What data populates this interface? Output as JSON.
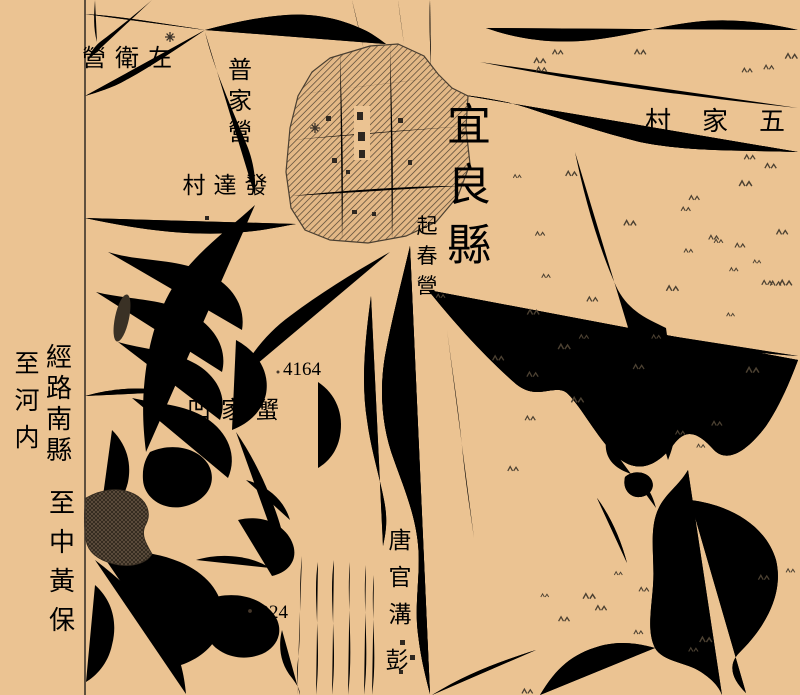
{
  "map": {
    "sheet_name": "宜良縣城附近地形圖",
    "colors": {
      "paper": "#ebc392",
      "ink": "#4c4132",
      "label": "#3a3127",
      "heavy_black": "#2e2720"
    },
    "margin_notes": [
      {
        "name": "note-to-hanoi",
        "text": "至河内",
        "mode": "v",
        "x": 27,
        "y": 372,
        "size": 25,
        "step": 37
      },
      {
        "name": "note-via-lunan-county",
        "text": "經路南縣",
        "mode": "v",
        "x": 59,
        "y": 366,
        "size": 26,
        "step": 31
      },
      {
        "name": "note-to-zhonghuangbao",
        "text": "至中黃保",
        "mode": "v",
        "x": 62,
        "y": 512,
        "size": 26,
        "step": 39
      }
    ],
    "labels": [
      {
        "name": "label-zuoweiying",
        "text": "左衛營",
        "mode": "h-rtl",
        "x": 160,
        "y": 66,
        "size": 24,
        "step": 33
      },
      {
        "name": "label-pujiaying",
        "text": "普家營",
        "mode": "v",
        "x": 240,
        "y": 78,
        "size": 24,
        "step": 31
      },
      {
        "name": "label-fadacun",
        "text": "發達村",
        "mode": "h-rtl",
        "x": 256,
        "y": 193,
        "size": 23,
        "step": 31
      },
      {
        "name": "label-yiliangxian",
        "text": "宜良縣",
        "mode": "v",
        "x": 469,
        "y": 140,
        "size": 44,
        "step": 60
      },
      {
        "name": "label-qichunying",
        "text": "起春營",
        "mode": "v",
        "x": 427,
        "y": 233,
        "size": 21,
        "step": 30
      },
      {
        "name": "label-wujiacun",
        "text": "五家村",
        "mode": "h-rtl",
        "x": 772,
        "y": 130,
        "size": 26,
        "step": 57
      },
      {
        "name": "label-xiejiaao",
        "text": "蟹家凹",
        "mode": "h-rtl",
        "x": 267,
        "y": 418,
        "size": 24,
        "step": 34
      },
      {
        "name": "label-tangguangou",
        "text": "唐官溝",
        "mode": "v",
        "x": 400,
        "y": 548,
        "size": 23,
        "step": 37
      },
      {
        "name": "label-peng",
        "text": "彭",
        "mode": "v",
        "x": 397,
        "y": 668,
        "size": 23,
        "step": 37
      },
      {
        "name": "spot-height-4164",
        "text": "4164",
        "mode": "h",
        "x": 283,
        "y": 375,
        "size": 19,
        "cls": "num"
      },
      {
        "name": "spot-height-4224",
        "text": "4224",
        "mode": "h",
        "x": 250,
        "y": 618,
        "size": 19,
        "cls": "num"
      }
    ]
  }
}
